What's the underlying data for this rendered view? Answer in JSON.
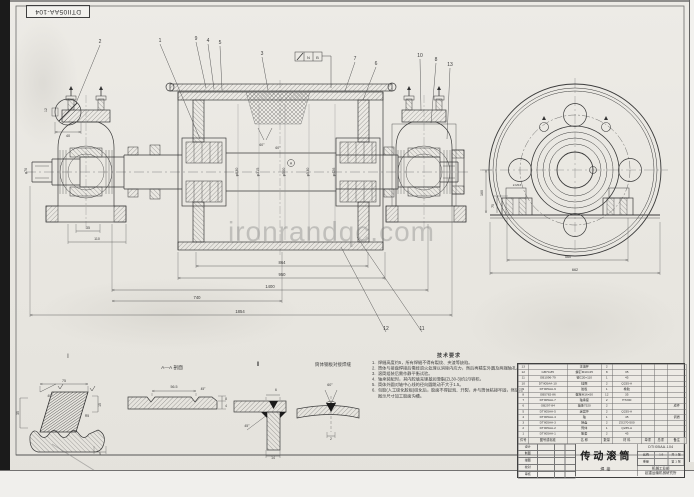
{
  "stamp": {
    "text": "DTII05AA-104"
  },
  "watermark": {
    "text": "ironrandqc.com"
  },
  "notes": {
    "title": "技术要求",
    "items": [
      "焊缝高度约5，所有焊缝不得有裂纹、夹渣等缺陷。",
      "筒体与接盘焊接后需经退火处理以消除内应力，然后再精车外圆及两端轴孔。",
      "滚筒组装后需作静平衡试验。",
      "轴承装配时，其内腔填充锂基润滑脂(ZL30-3)约2/3容积。",
      "筒体外圆对轴中心线的径向圆跳动不大于1.5。",
      "包胶(人工硫化胶板)硫化后，胶面不得起泡、开裂，并与筒体粘接牢固，然后按图示尺寸加工胶面沟槽。"
    ]
  },
  "annotations": {
    "view_labels": [
      {
        "t": "I",
        "x": 68,
        "y": 358,
        "s": 6
      },
      {
        "t": "Ⅱ",
        "x": 258,
        "y": 366,
        "s": 6
      },
      {
        "t": "A—A 剖面",
        "x": 172,
        "y": 369,
        "s": 4.8
      },
      {
        "t": "筒体钢板对接焊缝",
        "x": 333,
        "y": 366,
        "s": 4.5
      }
    ],
    "balloons": [
      {
        "n": "2",
        "x": 100,
        "y": 43,
        "lx": 76,
        "ly": 103
      },
      {
        "n": "1",
        "x": 160,
        "y": 42,
        "lx": 200,
        "ly": 139
      },
      {
        "n": "9",
        "x": 196,
        "y": 40,
        "lx": 206,
        "ly": 88
      },
      {
        "n": "4",
        "x": 208,
        "y": 42,
        "lx": 214,
        "ly": 89
      },
      {
        "n": "5",
        "x": 220,
        "y": 44,
        "lx": 222,
        "ly": 90
      },
      {
        "n": "3",
        "x": 262,
        "y": 55,
        "lx": 268,
        "ly": 90
      },
      {
        "n": "7",
        "x": 355,
        "y": 60,
        "lx": 345,
        "ly": 91
      },
      {
        "n": "6",
        "x": 376,
        "y": 65,
        "lx": 363,
        "ly": 100
      },
      {
        "n": "10",
        "x": 420,
        "y": 57,
        "lx": 421,
        "ly": 111
      },
      {
        "n": "8",
        "x": 436,
        "y": 61,
        "lx": 431,
        "ly": 123
      },
      {
        "n": "13",
        "x": 450,
        "y": 66,
        "lx": 447,
        "ly": 139
      },
      {
        "n": "12",
        "x": 386,
        "y": 330,
        "lx": 341,
        "ly": 247
      },
      {
        "n": "11",
        "x": 422,
        "y": 330,
        "lx": 357,
        "ly": 237
      }
    ],
    "dimensions": [
      {
        "t": "864",
        "x": 282,
        "y": 264
      },
      {
        "t": "950",
        "x": 282,
        "y": 276
      },
      {
        "t": "1400",
        "x": 270,
        "y": 288
      },
      {
        "t": "740",
        "x": 197,
        "y": 299
      },
      {
        "t": "1854",
        "x": 240,
        "y": 313
      },
      {
        "t": "35",
        "x": 88,
        "y": 229,
        "s": 3.6
      },
      {
        "t": "110",
        "x": 97,
        "y": 240,
        "s": 3.6
      },
      {
        "t": "40",
        "x": 68,
        "y": 137,
        "s": 3.8
      },
      {
        "t": "12",
        "x": 47,
        "y": 110,
        "r": -90,
        "s": 3.5
      },
      {
        "t": "φ70",
        "x": 27,
        "y": 171,
        "r": -90,
        "s": 3.6
      },
      {
        "t": "φ630",
        "x": 238,
        "y": 172,
        "r": -90,
        "s": 3.8
      },
      {
        "t": "φ315",
        "x": 259,
        "y": 172,
        "r": -90,
        "s": 3.8
      },
      {
        "t": "φ500",
        "x": 285,
        "y": 172,
        "r": -90,
        "s": 3.8
      },
      {
        "t": "φ530",
        "x": 309,
        "y": 172,
        "r": -90,
        "s": 3.8
      },
      {
        "t": "φ426",
        "x": 335,
        "y": 172,
        "r": -90,
        "s": 3.8
      },
      {
        "t": "60°",
        "x": 262,
        "y": 146,
        "s": 3.4
      },
      {
        "t": "60°",
        "x": 278,
        "y": 149,
        "s": 3.4
      },
      {
        "t": "A",
        "x": 291,
        "y": 164.5,
        "s": 3.4
      },
      {
        "t": "N",
        "x": 308.5,
        "y": 59,
        "s": 4
      },
      {
        "t": "B",
        "x": 317.5,
        "y": 59,
        "s": 4
      },
      {
        "t": "560",
        "x": 568,
        "y": 258,
        "s": 3.8
      },
      {
        "t": "662",
        "x": 575,
        "y": 271,
        "s": 3.8
      },
      {
        "t": "160",
        "x": 483,
        "y": 193,
        "r": -90,
        "s": 3.6
      },
      {
        "t": "75",
        "x": 494,
        "y": 206,
        "r": -90,
        "s": 3.4
      },
      {
        "t": "2-M16",
        "x": 517,
        "y": 186,
        "s": 3
      },
      {
        "t": "75",
        "x": 64,
        "y": 382,
        "s": 3.6
      },
      {
        "t": "40°",
        "x": 50,
        "y": 397,
        "s": 3.4
      },
      {
        "t": "R5",
        "x": 87,
        "y": 417,
        "s": 3.4
      },
      {
        "t": "15",
        "x": 101,
        "y": 405,
        "r": -90,
        "s": 3.4
      },
      {
        "t": "35",
        "x": 19,
        "y": 413,
        "r": -90,
        "s": 3.4
      },
      {
        "t": "5",
        "x": 100,
        "y": 455,
        "s": 3.4
      },
      {
        "t": "56.5",
        "x": 174,
        "y": 388,
        "s": 3.6
      },
      {
        "t": "45°",
        "x": 203,
        "y": 390,
        "s": 3.2
      },
      {
        "t": "8",
        "x": 226,
        "y": 400,
        "s": 3.2
      },
      {
        "t": "4",
        "x": 226,
        "y": 407,
        "s": 3.2
      },
      {
        "t": "6",
        "x": 276,
        "y": 391,
        "s": 3.4
      },
      {
        "t": "45°",
        "x": 247,
        "y": 427,
        "s": 3.4
      },
      {
        "t": "14",
        "x": 273,
        "y": 459,
        "s": 3.4
      },
      {
        "t": "60°",
        "x": 330,
        "y": 386,
        "s": 3.6
      },
      {
        "t": "2",
        "x": 331,
        "y": 440,
        "s": 3.4
      }
    ]
  },
  "title_block": {
    "title": "传动滚筒",
    "subtitle": "焊接",
    "drawing_no": "DTII05AA-104",
    "company1": "机械工业部",
    "company2": "起重运输机械研究所",
    "info_cells": [
      "比例",
      "1:5",
      "共 1 张",
      "重量",
      "",
      "第 1 张"
    ],
    "sign_rows": [
      [
        "设计",
        "",
        "",
        ""
      ],
      [
        "制图",
        "",
        "",
        ""
      ],
      [
        "描图",
        "",
        "",
        ""
      ],
      [
        "校对",
        "",
        "",
        ""
      ],
      [
        "审核",
        "",
        "",
        ""
      ]
    ],
    "bom": {
      "headers": [
        "件号",
        "图号或标准",
        "名 称",
        "数量",
        "材 料",
        "单重",
        "总重",
        "备注"
      ],
      "rows": [
        [
          "13",
          "",
          "注油杯",
          "2",
          "",
          "",
          "",
          ""
        ],
        [
          "12",
          "GB70-85",
          "螺钉M10×25",
          "8",
          "35",
          "",
          "",
          ""
        ],
        [
          "11",
          "GB1096-79",
          "键C20×110",
          "1",
          "45",
          "",
          "",
          ""
        ],
        [
          "10",
          "DTII05AA-10",
          "挡圈",
          "2",
          "Q235-A",
          "",
          "",
          ""
        ],
        [
          "9",
          "DTII05AA-9",
          "胶板",
          "1",
          "橡胶",
          "",
          "",
          ""
        ],
        [
          "8",
          "GB5782-86",
          "螺栓M16×50",
          "12",
          "35",
          "",
          "",
          ""
        ],
        [
          "7",
          "DTII05AA-7",
          "轴承座",
          "2",
          "HT200",
          "",
          "",
          ""
        ],
        [
          "6",
          "GB297-84",
          "轴承7520",
          "2",
          "",
          "",
          "",
          "成件"
        ],
        [
          "5",
          "DTII05AA-5",
          "迷宫环",
          "2",
          "Q235-A",
          "",
          "",
          ""
        ],
        [
          "4",
          "DTII05AA-4",
          "轴",
          "1",
          "45",
          "",
          "",
          "调质"
        ],
        [
          "3",
          "DTII05AA-3",
          "接盘",
          "2",
          "ZG270-500",
          "",
          "",
          ""
        ],
        [
          "2",
          "DTII05AA-2",
          "筒体",
          "1",
          "Q235-A",
          "",
          "",
          ""
        ],
        [
          "1",
          "DTII05AA-1",
          "胀套",
          "2",
          "45",
          "",
          "",
          ""
        ]
      ]
    }
  }
}
